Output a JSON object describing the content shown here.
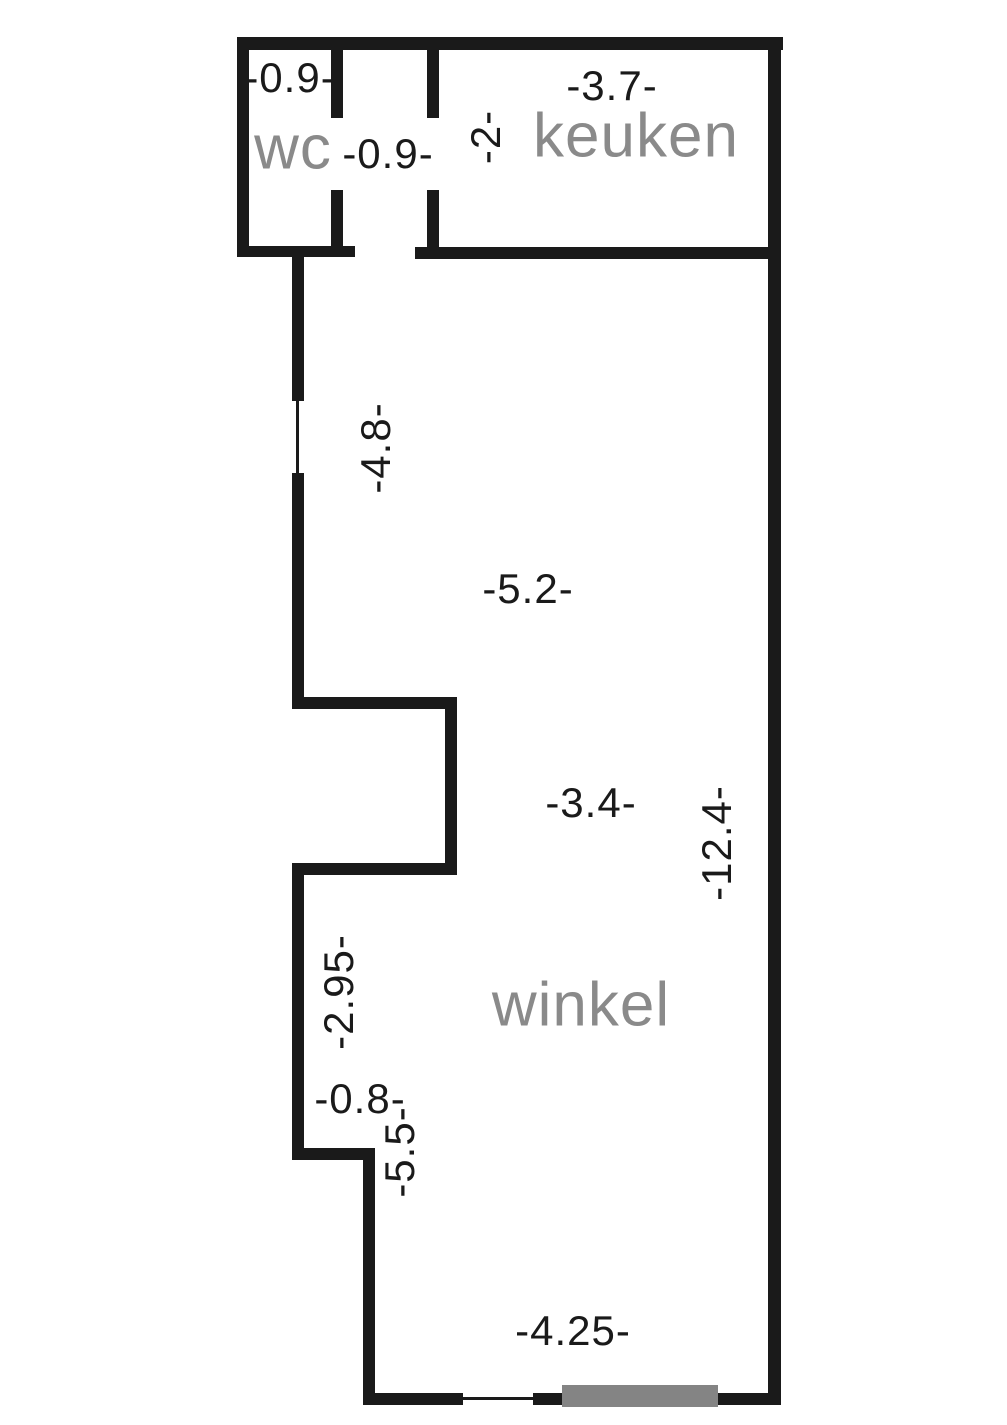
{
  "floorplan": {
    "type": "floor-plan",
    "rooms": {
      "wc": "wc",
      "keuken": "keuken",
      "winkel": "winkel"
    },
    "dims": {
      "wc_width": "-0.9-",
      "hall_width": "-0.9-",
      "keuken_depth": "-2-",
      "keuken_width": "-3.7-",
      "left_upper_height": "-4.8-",
      "shop_upper_width": "-5.2-",
      "shop_mid_width": "-3.4-",
      "shop_depth": "-12.4-",
      "left_mid_height": "-2.95-",
      "notch_width": "-0.8-",
      "left_bottom_height": "-5.5-",
      "front_width": "-4.25-"
    },
    "colors": {
      "wall": "#1a1a1a",
      "door": "#848484",
      "room_label": "#8a8a8a",
      "dim_label": "#1a1a1a",
      "background": "#ffffff"
    }
  }
}
